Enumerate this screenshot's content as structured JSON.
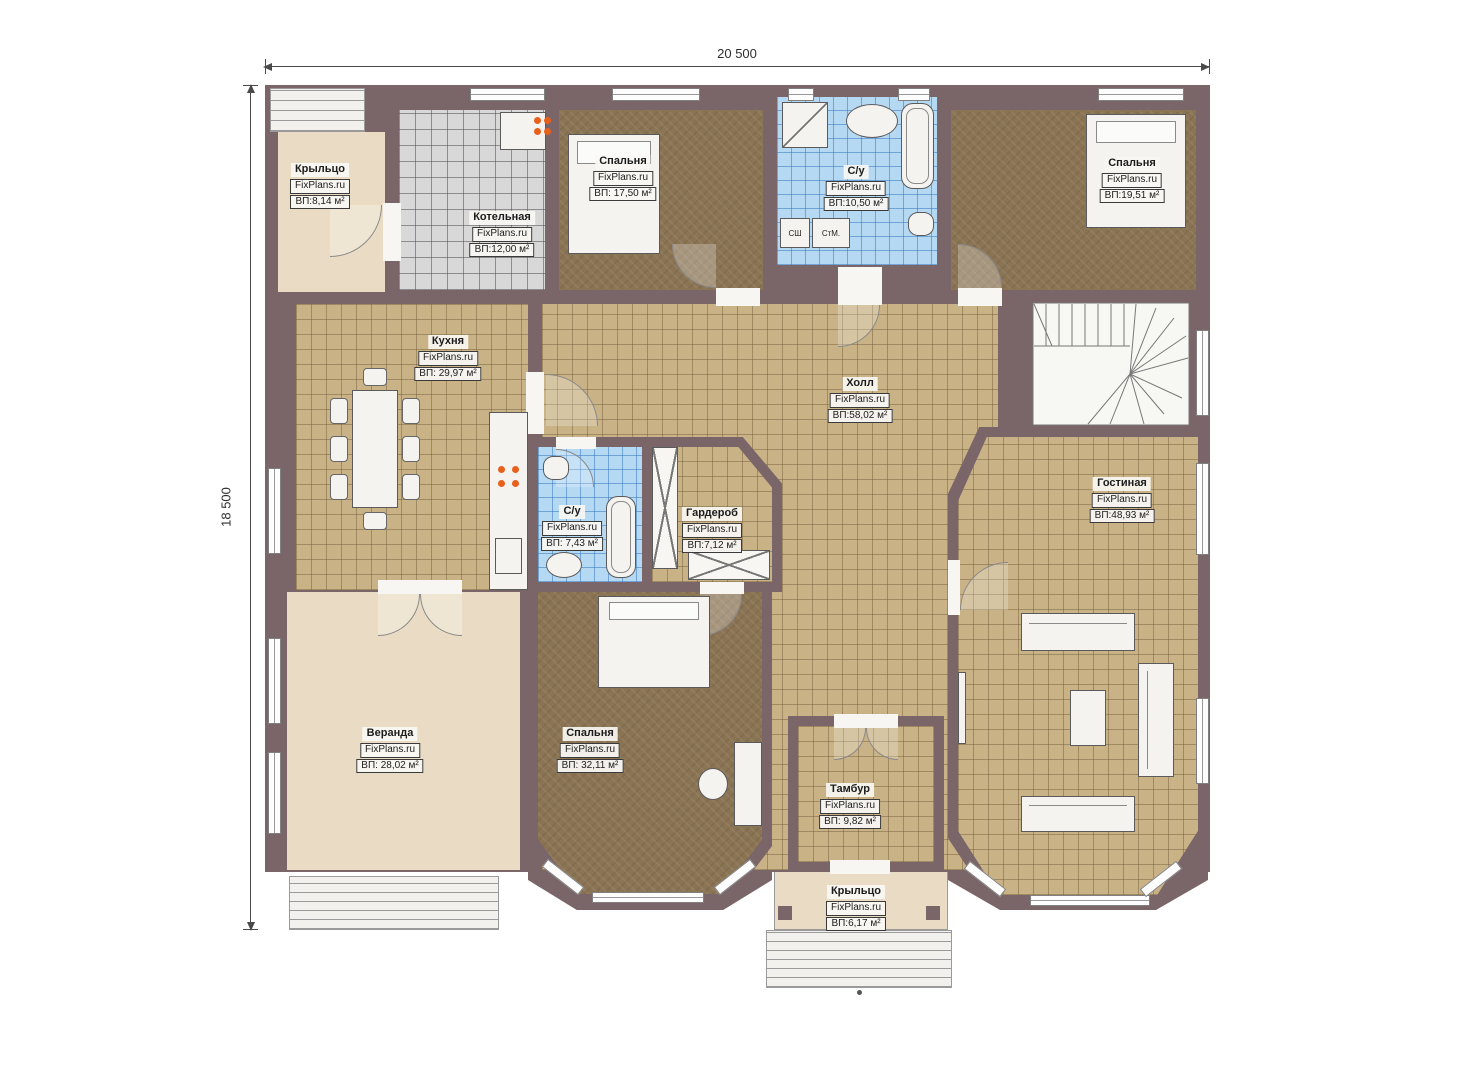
{
  "dimensions": {
    "width": "20 500",
    "height": "18 500"
  },
  "brand": "FixPlans.ru",
  "rooms": [
    {
      "name": "Крыльцо",
      "brand": "FixPlans.ru",
      "area": "ВП:8,14 м²"
    },
    {
      "name": "Котельная",
      "brand": "FixPlans.ru",
      "area": "ВП:12,00 м²"
    },
    {
      "name": "Спальня",
      "brand": "FixPlans.ru",
      "area": "ВП: 17,50 м²"
    },
    {
      "name": "С/у",
      "brand": "FixPlans.ru",
      "area": "ВП:10,50 м²"
    },
    {
      "name": "Спальня",
      "brand": "FixPlans.ru",
      "area": "ВП:19,51 м²"
    },
    {
      "name": "Кухня",
      "brand": "FixPlans.ru",
      "area": "ВП: 29,97 м²"
    },
    {
      "name": "Холл",
      "brand": "FixPlans.ru",
      "area": "ВП:58,02 м²"
    },
    {
      "name": "Гостиная",
      "brand": "FixPlans.ru",
      "area": "ВП:48,93 м²"
    },
    {
      "name": "С/у",
      "brand": "FixPlans.ru",
      "area": "ВП: 7,43 м²"
    },
    {
      "name": "Гардероб",
      "brand": "FixPlans.ru",
      "area": "ВП:7,12 м²"
    },
    {
      "name": "Веранда",
      "brand": "FixPlans.ru",
      "area": "ВП: 28,02 м²"
    },
    {
      "name": "Спальня",
      "brand": "FixPlans.ru",
      "area": "ВП: 32,11 м²"
    },
    {
      "name": "Тамбур",
      "brand": "FixPlans.ru",
      "area": "ВП: 9,82 м²"
    },
    {
      "name": "Крыльцо",
      "brand": "FixPlans.ru",
      "area": "ВП:6,17 м²"
    }
  ],
  "appliances": {
    "dryer": "СШ",
    "washer": "СтМ."
  },
  "colors": {
    "wall": "#7a6569",
    "tile_tan": "#c9b285",
    "tile_blue": "#b5d8f3",
    "tile_gray": "#d8d8d8",
    "carpet_brown": "#8b7454",
    "floor_beige": "#eadcc4",
    "burner_orange": "#e8611c"
  }
}
